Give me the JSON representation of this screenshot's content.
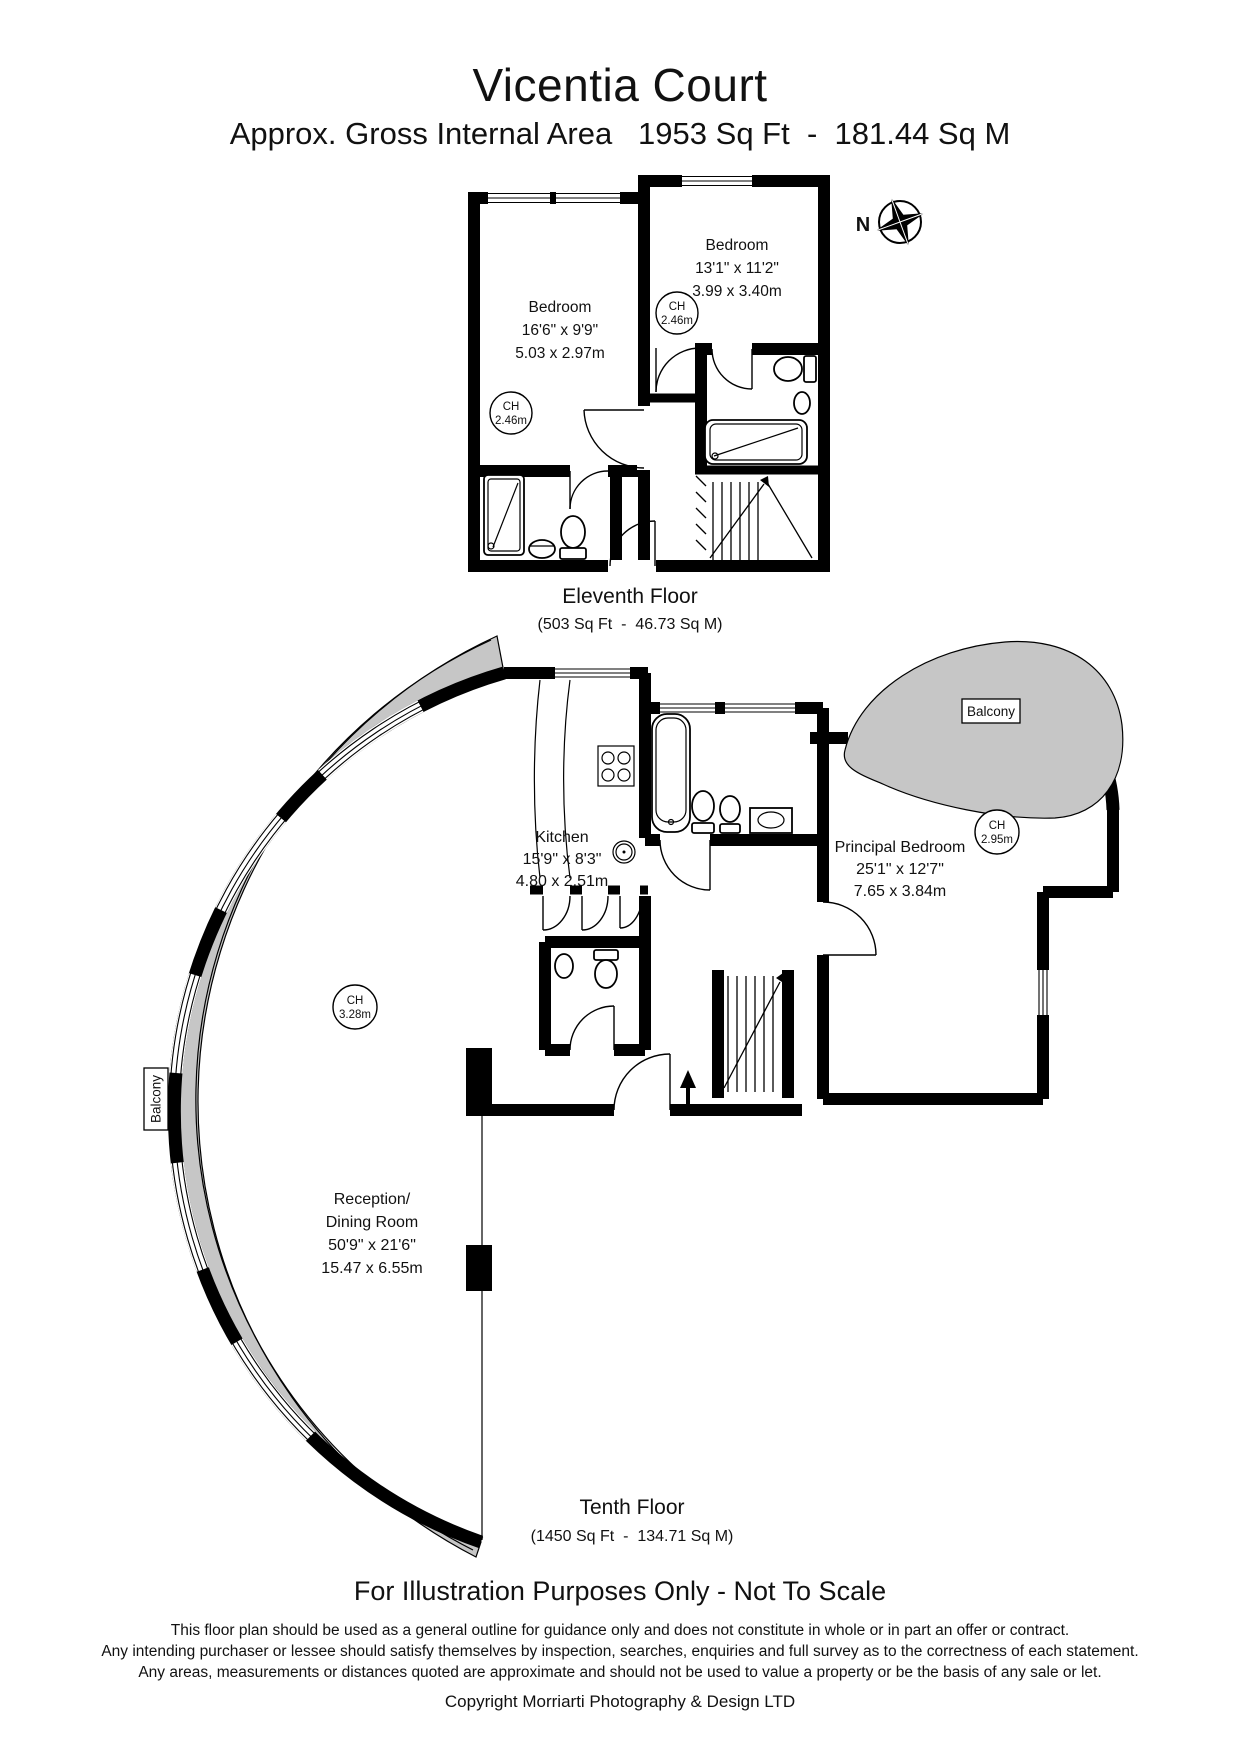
{
  "header": {
    "title": "Vicentia Court",
    "subtitle": "Approx. Gross Internal Area   1953 Sq Ft  -  181.44 Sq M"
  },
  "compass": {
    "north": "N"
  },
  "floors": {
    "eleventh": {
      "label": "Eleventh Floor",
      "area": "(503 Sq Ft  -  46.73 Sq M)",
      "bedroom_left": {
        "name": "Bedroom",
        "imperial": "16'6\" x 9'9\"",
        "metric": "5.03 x 2.97m"
      },
      "bedroom_right": {
        "name": "Bedroom",
        "imperial": "13'1\" x 11'2\"",
        "metric": "3.99 x 3.40m"
      },
      "ch_left": {
        "label": "CH",
        "value": "2.46m"
      },
      "ch_right": {
        "label": "CH",
        "value": "2.46m"
      }
    },
    "tenth": {
      "label": "Tenth Floor",
      "area": "(1450 Sq Ft  -  134.71 Sq M)",
      "kitchen": {
        "name": "Kitchen",
        "imperial": "15'9\" x 8'3\"",
        "metric": "4.80 x 2.51m"
      },
      "principal_bedroom": {
        "name": "Principal Bedroom",
        "imperial": "25'1\" x 12'7\"",
        "metric": "7.65 x 3.84m"
      },
      "reception": {
        "name_line1": "Reception/",
        "name_line2": "Dining Room",
        "imperial": "50'9\" x 21'6\"",
        "metric": "15.47 x 6.55m"
      },
      "ch_bedroom": {
        "label": "CH",
        "value": "2.95m"
      },
      "ch_reception": {
        "label": "CH",
        "value": "3.28m"
      },
      "balcony_right": "Balcony",
      "balcony_left": "Balcony"
    }
  },
  "footer": {
    "notice": "For Illustration Purposes Only - Not To Scale",
    "disclaimer_line1": "This floor plan should be used as a general outline for guidance only and does not constitute in whole or in part an offer or contract.",
    "disclaimer_line2": "Any intending purchaser or lessee should satisfy themselves by inspection, searches, enquiries and full survey as to the correctness of each statement.",
    "disclaimer_line3": "Any areas, measurements or distances quoted are approximate and should not be used to value a property or be the basis of any sale or let.",
    "copyright": "Copyright Morriarti Photography & Design LTD"
  },
  "colors": {
    "balcony_fill": "#c6c6c6",
    "wall": "#000000",
    "background": "#ffffff"
  }
}
